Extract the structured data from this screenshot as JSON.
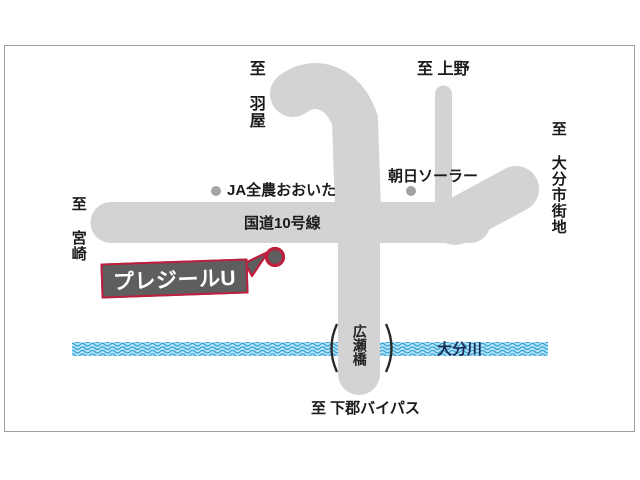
{
  "callout": {
    "label": "プレジールU"
  },
  "roads": {
    "route10_label": "国道10号線",
    "hirose_bridge_label": "広瀬橋"
  },
  "river": {
    "name": "大分川"
  },
  "destinations": {
    "haneya": "至 羽屋",
    "ueno": "至 上野",
    "oita_city": "至 大分市街地",
    "miyazaki": "至 宮崎",
    "shimogori_bypass": "至 下郡バイパス"
  },
  "landmarks": {
    "ja_zennoh": "JA全農おおいた",
    "asahi_solar": "朝日ソーラー"
  },
  "colors": {
    "road": "#d3d3d3",
    "accent": "#bf1e3e",
    "box_fill": "#5e5e5e",
    "river_base": "#b5e3f7",
    "river_wave": "#2f9fd4",
    "river_text": "#1c2c54",
    "dot": "#a3a3a3",
    "ink": "#1a1a1a",
    "frame": "#9aa0a6"
  }
}
